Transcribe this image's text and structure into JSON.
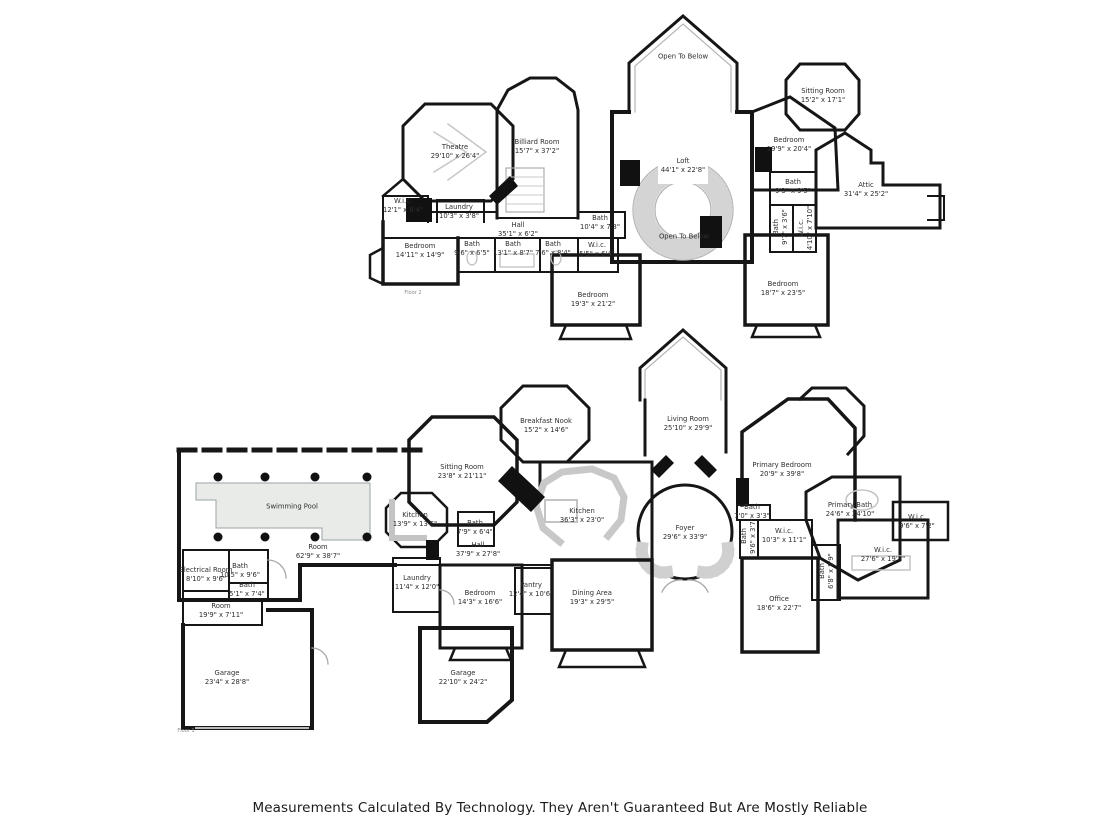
{
  "footer": {
    "disclaimer": "Measurements Calculated By Technology. They Aren't Guaranteed But Are Mostly Reliable"
  },
  "floor2": {
    "tag": "Floor 2",
    "rooms": [
      {
        "name": "Open To Below",
        "dims": ""
      },
      {
        "name": "Sitting Room",
        "dims": "15'2\" x 17'1\""
      },
      {
        "name": "Theatre",
        "dims": "29'10\" x 26'4\""
      },
      {
        "name": "Billiard Room",
        "dims": "15'7\" x 37'2\""
      },
      {
        "name": "Loft",
        "dims": "44'1\" x 22'8\""
      },
      {
        "name": "Bedroom",
        "dims": "19'9\" x 20'4\""
      },
      {
        "name": "Bath",
        "dims": "9'3\" x 9'5\""
      },
      {
        "name": "Attic",
        "dims": "31'4\" x 25'2\""
      },
      {
        "name": "W.i.c.",
        "dims": "12'1\" x 8'4\""
      },
      {
        "name": "Laundry",
        "dims": "10'3\" x 3'8\""
      },
      {
        "name": "Hall",
        "dims": "35'1\" x 6'2\""
      },
      {
        "name": "Bath",
        "dims": "10'4\" x 7'3\""
      },
      {
        "name": "Open To Below",
        "dims": ""
      },
      {
        "name": "W.i.c.",
        "dims": "5'5\" x 6'4\""
      },
      {
        "name": "Bedroom",
        "dims": "14'11\" x 14'9\""
      },
      {
        "name": "Bath",
        "dims": "9'6\" x 6'5\""
      },
      {
        "name": "Bath",
        "dims": "13'1\" x 8'7\""
      },
      {
        "name": "Bath",
        "dims": "7'6\" x 8'4\""
      },
      {
        "name": "Bath",
        "dims": "9'7\" x 3'6\""
      },
      {
        "name": "W.i.c.",
        "dims": "4'10\" x 7'10\""
      },
      {
        "name": "Bedroom",
        "dims": "19'3\" x 21'2\""
      },
      {
        "name": "Bedroom",
        "dims": "18'7\" x 23'5\""
      }
    ]
  },
  "floor1": {
    "tag": "Floor 1",
    "rooms": [
      {
        "name": "Living Room",
        "dims": "25'10\" x 29'9\""
      },
      {
        "name": "Breakfast Nook",
        "dims": "15'2\" x 14'6\""
      },
      {
        "name": "Sitting Room",
        "dims": "23'8\" x 21'11\""
      },
      {
        "name": "Primary Bedroom",
        "dims": "20'9\" x 39'8\""
      },
      {
        "name": "Swimming Pool",
        "dims": ""
      },
      {
        "name": "Kitchen",
        "dims": "13'9\" x 13'6\""
      },
      {
        "name": "Kitchen",
        "dims": "36'3\" x 23'0\""
      },
      {
        "name": "Foyer",
        "dims": "29'6\" x 33'9\""
      },
      {
        "name": "Primary Bath",
        "dims": "24'6\" x 24'10\""
      },
      {
        "name": "Bath",
        "dims": "7'0\" x 3'3\""
      },
      {
        "name": "W.i.c.",
        "dims": "10'3\" x 11'1\""
      },
      {
        "name": "W.i.c.",
        "dims": "9'6\" x 7'2\""
      },
      {
        "name": "Bath",
        "dims": "7'9\" x 6'4\""
      },
      {
        "name": "Hall",
        "dims": "37'9\" x 27'8\""
      },
      {
        "name": "Room",
        "dims": "62'9\" x 38'7\""
      },
      {
        "name": "W.i.c.",
        "dims": "27'6\" x 19'7\""
      },
      {
        "name": "Electrical Room",
        "dims": "8'10\" x 9'6\""
      },
      {
        "name": "Bath",
        "dims": "10'5\" x 9'6\""
      },
      {
        "name": "Bath",
        "dims": "5'1\" x 7'4\""
      },
      {
        "name": "Room",
        "dims": "19'9\" x 7'11\""
      },
      {
        "name": "Laundry",
        "dims": "11'4\" x 12'0\""
      },
      {
        "name": "Bedroom",
        "dims": "14'3\" x 16'6\""
      },
      {
        "name": "Pantry",
        "dims": "12'4\" x 10'6\""
      },
      {
        "name": "Dining Area",
        "dims": "19'3\" x 29'5\""
      },
      {
        "name": "Bath",
        "dims": "9'6\" x 3'7\""
      },
      {
        "name": "Bath",
        "dims": "6'8\" x 8'9\""
      },
      {
        "name": "Office",
        "dims": "18'6\" x 22'7\""
      },
      {
        "name": "Garage",
        "dims": "23'4\" x 28'8\""
      },
      {
        "name": "Garage",
        "dims": "22'10\" x 24'2\""
      }
    ]
  }
}
